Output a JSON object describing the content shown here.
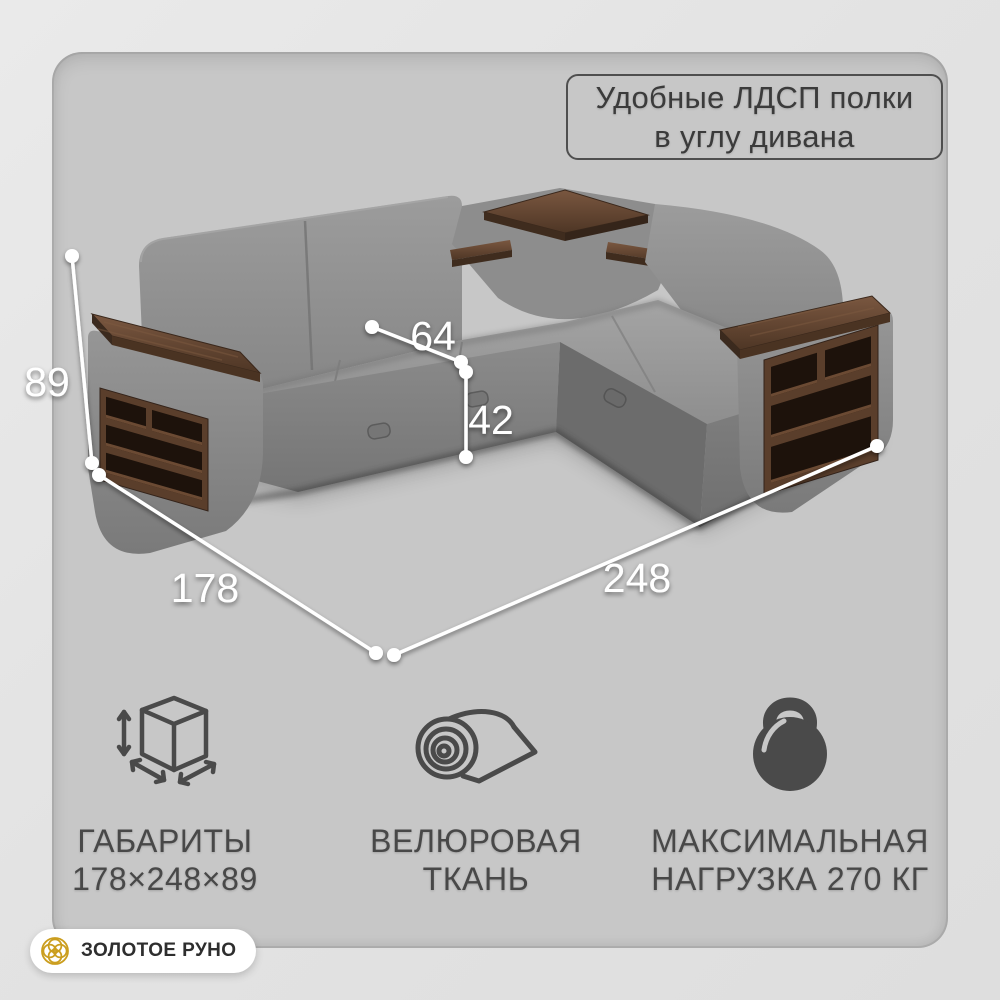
{
  "theme": {
    "outer_bg": "#e3e3e3",
    "panel_bg": "#c7c7c7",
    "fabric_gray": "#8d8d8d",
    "wood_brown": "#5a3e2b",
    "shelf_cavity": "#1d120b",
    "dimension_line": "#ffffff",
    "text_dark": "#3b3b3b",
    "icon_gray": "#4a4a4a",
    "brand_gold": "#cb9e1e",
    "badge_bg": "#ffffff"
  },
  "callout": {
    "line1": "Удобные ЛДСП полки",
    "line2": "в углу дивана"
  },
  "dimensions": {
    "height": "89",
    "seat_depth": "64",
    "seat_height": "42",
    "width": "178",
    "length": "248"
  },
  "features": [
    {
      "icon": "cube-dimensions-icon",
      "line1": "ГАБАРИТЫ",
      "line2": "178×248×89"
    },
    {
      "icon": "fabric-roll-icon",
      "line1": "ВЕЛЮРОВАЯ",
      "line2": "ТКАНЬ"
    },
    {
      "icon": "kettlebell-icon",
      "line1": "МАКСИМАЛЬНАЯ",
      "line2": "НАГРУЗКА 270 КГ"
    }
  ],
  "brand": {
    "logo_icon": "golden-fleece-rings-icon",
    "name": "ЗОЛОТОЕ РУНО"
  }
}
